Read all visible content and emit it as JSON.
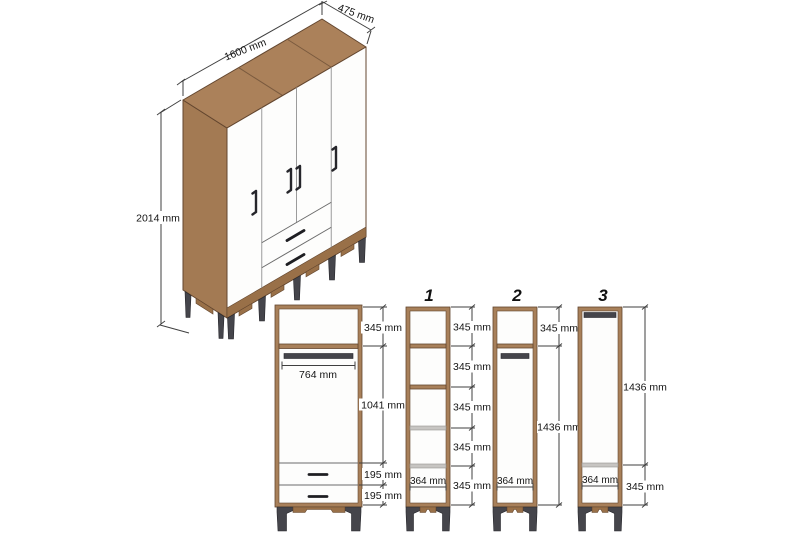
{
  "figure": {
    "kind": "wardrobe dimension diagram",
    "views": "isometric overview plus internal front views",
    "door_count": 4,
    "drawer_count": 2
  },
  "isometric": {
    "width_label": "1600 mm",
    "depth_label": "475 mm",
    "height_label": "2014 mm"
  },
  "front_view": {
    "top_section_label": "345 mm",
    "rod_width_label": "764 mm",
    "hanging_section_label": "1041 mm",
    "drawer_labels": [
      "195 mm",
      "195 mm"
    ]
  },
  "units": [
    {
      "number": "1",
      "sections": [
        "345 mm",
        "345 mm",
        "345 mm",
        "345 mm",
        "345 mm"
      ],
      "width_label": "364 mm"
    },
    {
      "number": "2",
      "sections": [
        "345 mm",
        "1436 mm"
      ],
      "width_label": "364 mm"
    },
    {
      "number": "3",
      "sections": [
        "1436 mm",
        "345 mm"
      ],
      "width_label": "364 mm"
    }
  ],
  "colors": {
    "wood": "#a8805a",
    "wood_dark": "#63462f",
    "wood_top": "#ab815a",
    "wood_side": "#a37a53",
    "base_wood": "#997048",
    "metal": "#45454b",
    "shelf_gray": "#c7c5c2",
    "dimension_line": "#3f3f3f",
    "background": "#ffffff"
  }
}
